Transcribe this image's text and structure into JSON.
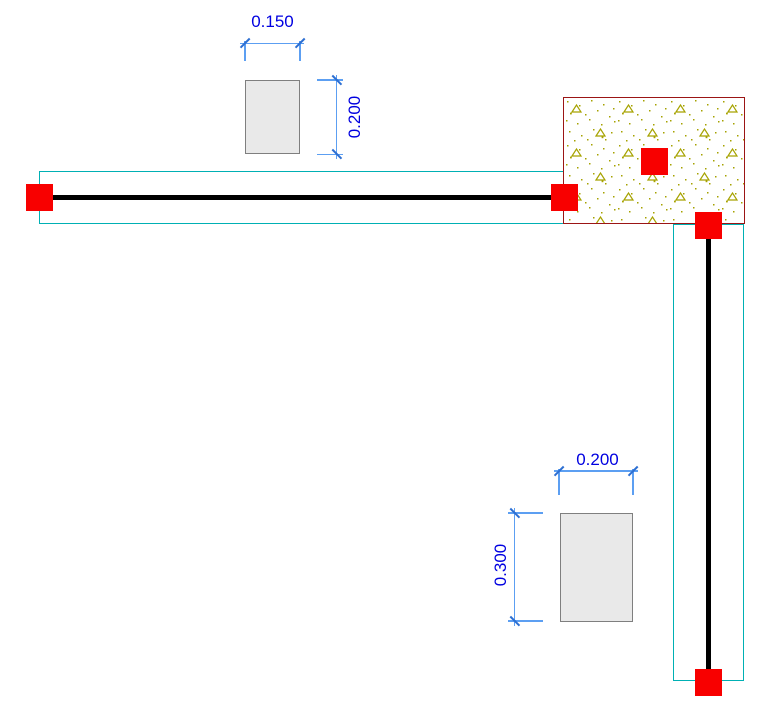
{
  "drawing": {
    "type": "structural-beam-plan-view",
    "dimensions": {
      "section_a_width": "0.150",
      "section_a_height": "0.200",
      "section_b_width": "0.200",
      "section_b_height": "0.300"
    },
    "elements": {
      "beam_count": 2,
      "node_count": 5,
      "section_preview_count": 2,
      "hatched_region_count": 1
    }
  },
  "colors": {
    "canvas_bg": "#FFFFFF",
    "node_red": "#F80000",
    "beam_black": "#000000",
    "outline_cyan": "#00B0B4",
    "dim_line_blue": "#5C9FF2",
    "dim_tick_blue": "#2D6FD2",
    "dim_text_blue": "#0000E0",
    "hatch_border": "#9B1515",
    "hatch_dot": "#A6A200",
    "section_fill": "#E9E9E9",
    "section_border": "#7F7F7F"
  }
}
